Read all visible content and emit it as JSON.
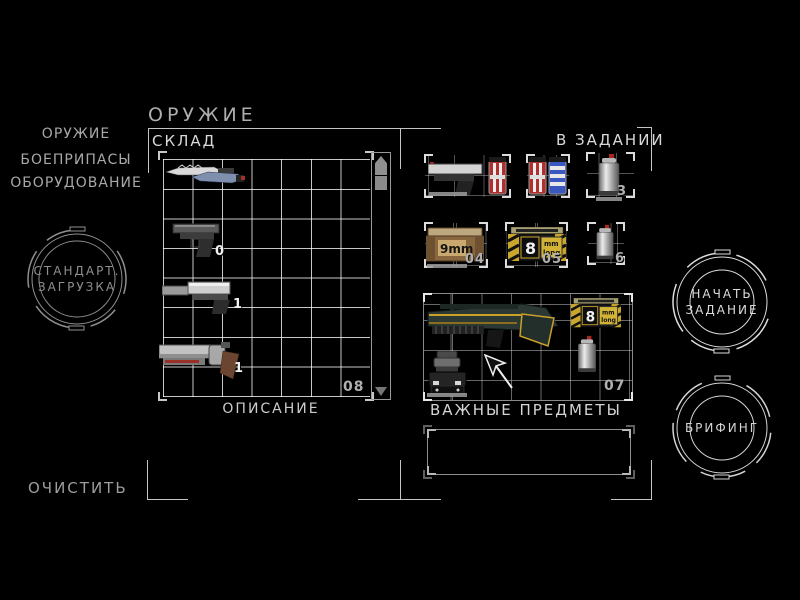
{
  "window": {
    "title": "ОРУЖИЕ"
  },
  "left_menu": {
    "items": [
      {
        "label": "ОРУЖИЕ"
      },
      {
        "label": "БОЕПРИПАСЫ"
      },
      {
        "label": "ОБОРУДОВАНИЕ"
      }
    ]
  },
  "buttons": {
    "standard_loadout": {
      "line1": "СТАНДАРТ.",
      "line2": "ЗАГРУЗКА"
    },
    "start_mission": {
      "line1": "НАЧАТЬ",
      "line2": "ЗАДАНИЕ"
    },
    "briefing": {
      "line1": "БРИФИНГ"
    },
    "clear": {
      "label": "ОЧИСТИТЬ"
    }
  },
  "storage": {
    "header": "СКЛАД",
    "total_count": "08",
    "description_label": "ОПИСАНИЕ",
    "items": [
      {
        "name": "combat-knives",
        "count": ""
      },
      {
        "name": "pistol",
        "count": "0"
      },
      {
        "name": "silenced-pistol",
        "count": "1"
      },
      {
        "name": "revolver-shotgun",
        "count": "1"
      }
    ]
  },
  "mission": {
    "header": "В ЗАДАНИИ",
    "important_header": "ВАЖНЫЕ ПРЕДМЕТЫ",
    "slots": [
      {
        "name": "pistol-with-magazine",
        "count": ""
      },
      {
        "name": "spare-magazines",
        "count": ""
      },
      {
        "name": "spray-can",
        "count": "3"
      },
      {
        "name": "ammo-box-9mm",
        "count": "04"
      },
      {
        "name": "ammo-box-8mm-long",
        "count": "05"
      },
      {
        "name": "spray-can-2",
        "count": "6"
      },
      {
        "name": "rifle-kit",
        "count": "07"
      }
    ],
    "ammo_labels": {
      "nine": "9mm",
      "eight": "8",
      "mm": "mm",
      "long": "long"
    }
  },
  "icons": {
    "scroll_up": "up-arrow-icon",
    "scroll_down": "down-arrow-icon",
    "cursor": "mouse-cursor-icon"
  },
  "colors": {
    "background": "#000000",
    "frame_line": "#c4c4c4",
    "text_dim": "#a8a8a8",
    "text_bright": "#d9d9d9",
    "ring_dim": "#8f8f8f",
    "ring_bright": "#dcdcdc",
    "ammo_yellow": "#caa62a",
    "crate_tan": "#8a683f",
    "mag_red": "#b03030",
    "mag_blue": "#3b57c0",
    "rifle_green": "#2b3833"
  }
}
